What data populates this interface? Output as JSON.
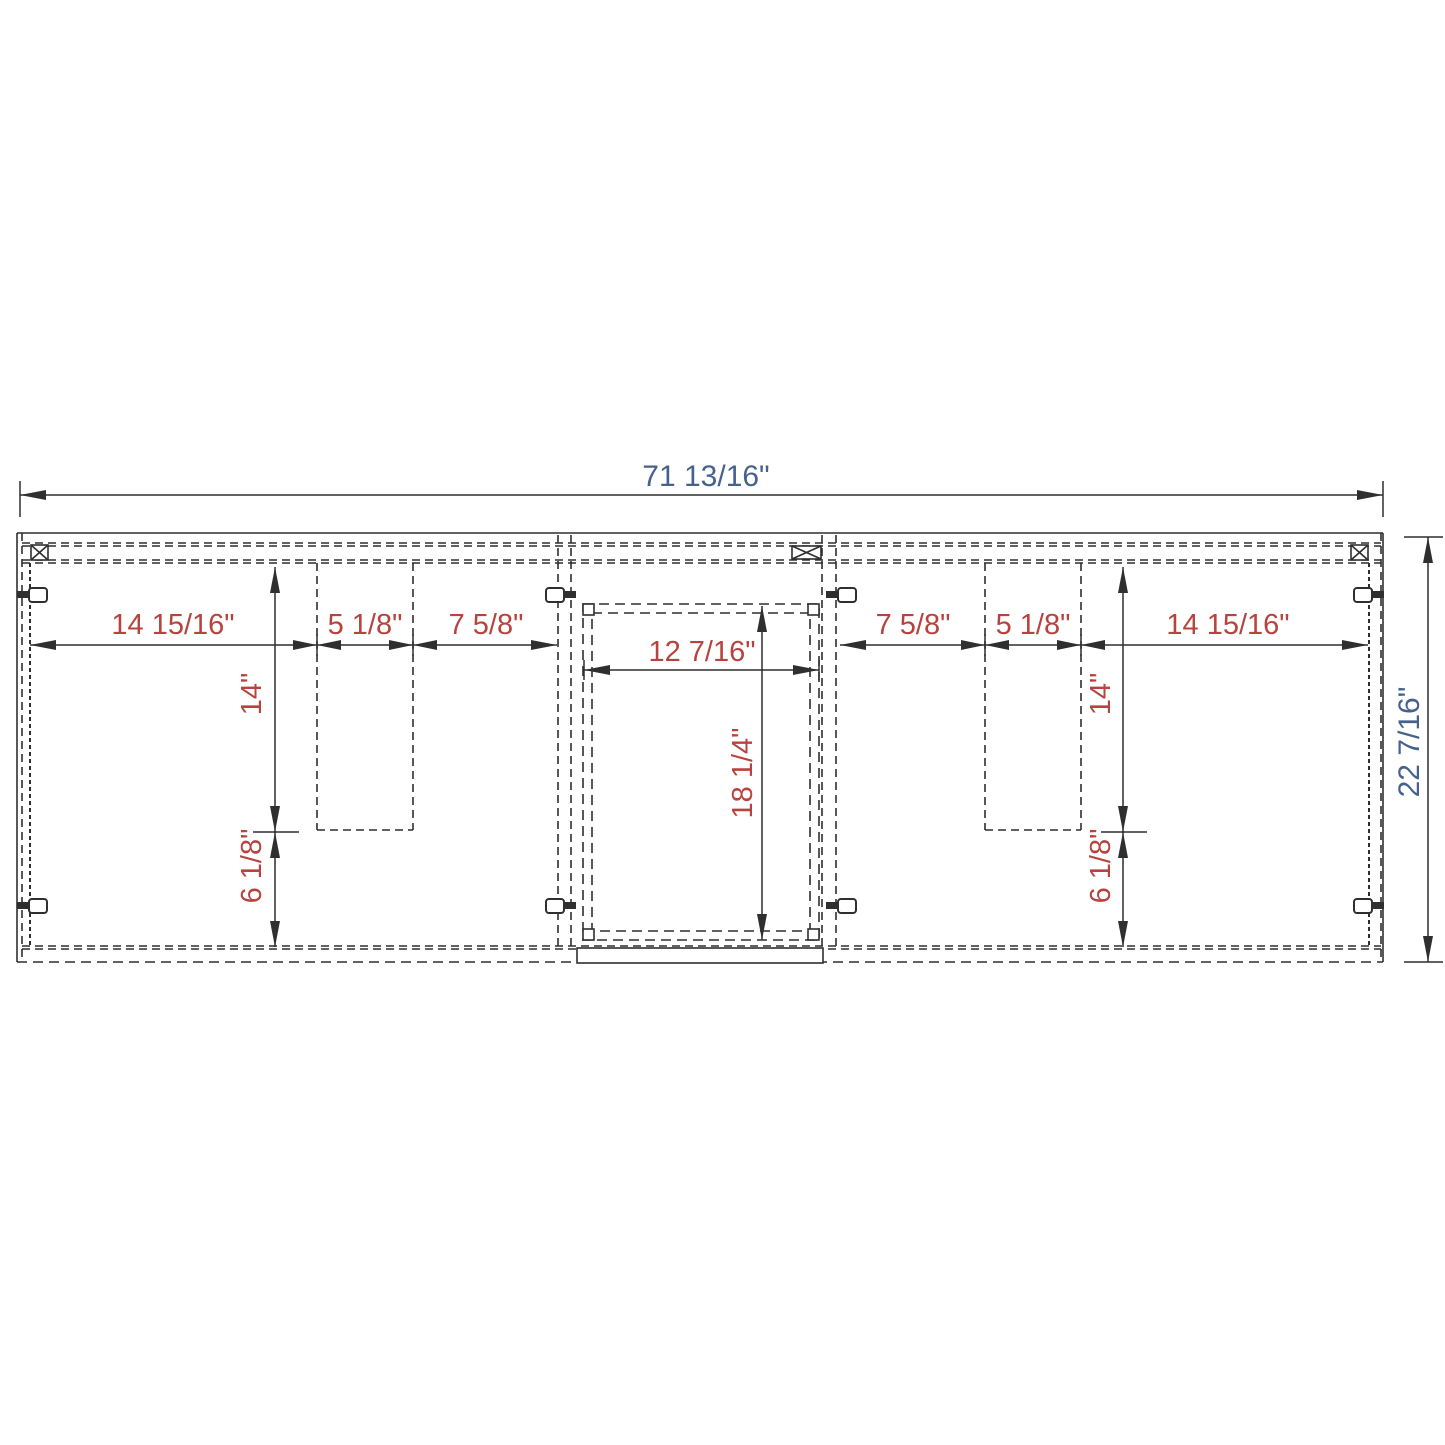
{
  "diagram": {
    "title": "cabinet-front-dimension-drawing",
    "units": "inches",
    "colors": {
      "line": "#2f2f2f",
      "internal_dim_text": "#b8433e",
      "overall_dim_text": "#47618f",
      "background": "#ffffff"
    },
    "overall": {
      "width_label": "71 13/16\"",
      "height_label": "22 7/16\""
    },
    "left_section": {
      "door_width": "14 15/16\"",
      "cutout_width": "5 1/8\"",
      "side_gap": "7 5/8\"",
      "cutout_height": "14\"",
      "below_cutout": "6 1/8\""
    },
    "center_section": {
      "opening_width": "12 7/16\"",
      "opening_height": "18 1/4\""
    },
    "right_section": {
      "side_gap": "7 5/8\"",
      "cutout_width": "5 1/8\"",
      "door_width": "14 15/16\"",
      "cutout_height": "14\"",
      "below_cutout": "6 1/8\""
    }
  }
}
